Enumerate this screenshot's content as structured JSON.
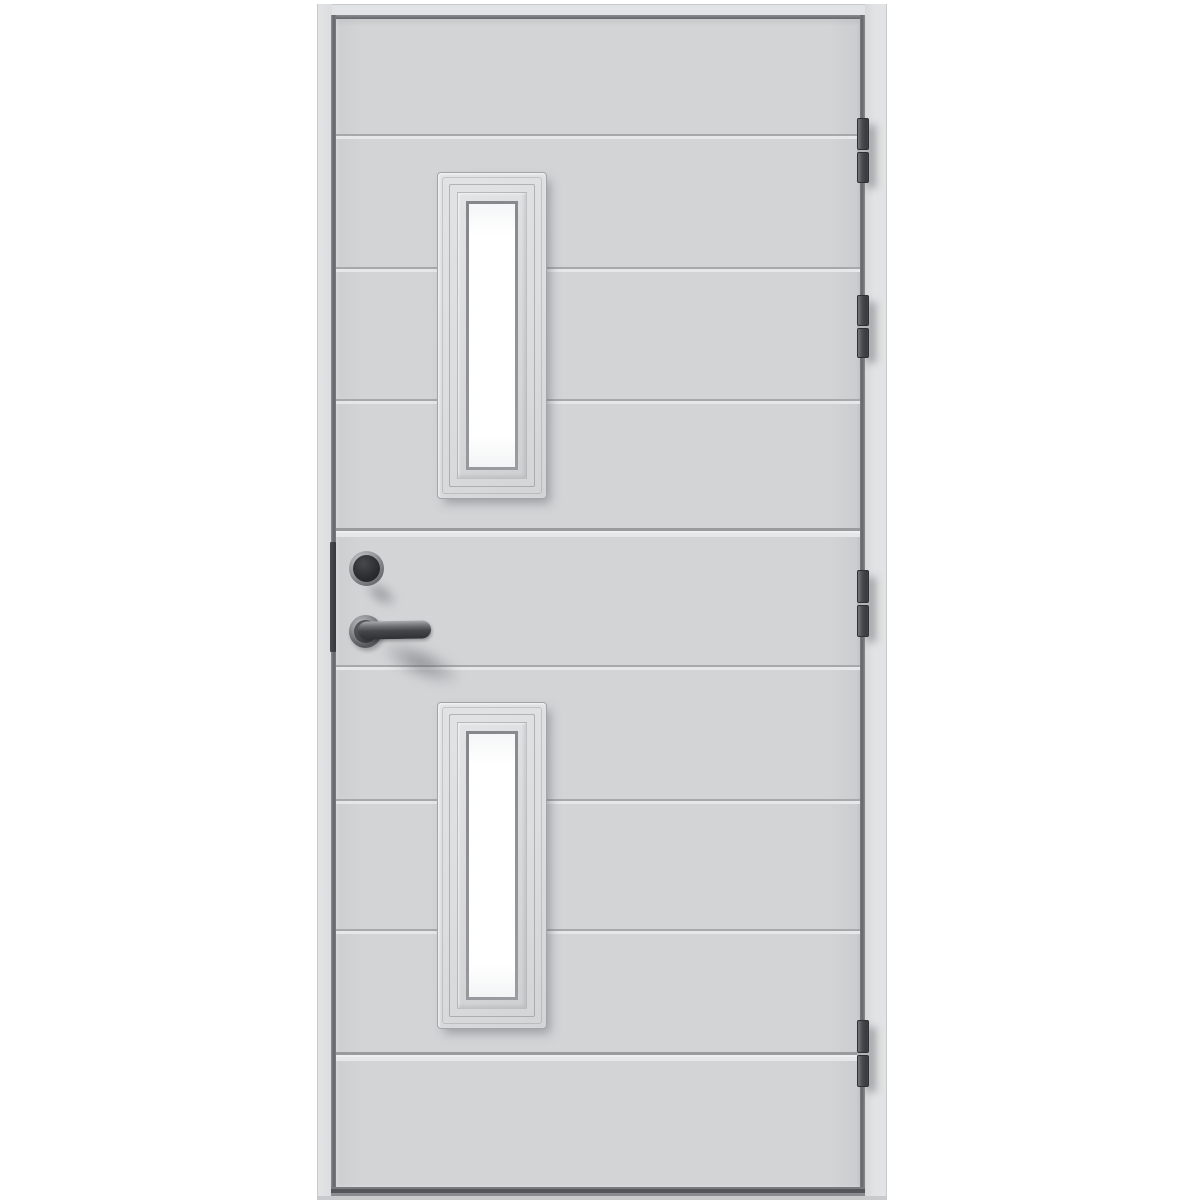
{
  "scene": {
    "type": "product-photo",
    "description": "Studio photograph of a light grey exterior entry door on a white background. The door leaf has horizontal plank grooves, two narrow vertical frosted-glass windows (one upper, one lower), a dark lever handle with round rosette, a round lock cylinder above the handle, an edge lock faceplate on the left edge, and four barrel hinges on the right edge.",
    "background_color": "#ffffff"
  },
  "door": {
    "leaf_finish": "light grey painted, horizontal plank pattern",
    "plank_groove_count": 6,
    "panel_seam_count": 2,
    "windows": {
      "count": 2,
      "shape": "narrow vertical rectangle with stepped moulding trim",
      "glass": "white frosted"
    },
    "hardware": {
      "handle": "dark metal lever handle on round rosette",
      "lock_cylinder": "round dark cylinder above handle",
      "edge_faceplate": "dark lock faceplate on left door edge",
      "hinge_count": 4,
      "hinge_side": "right"
    }
  },
  "colors": {
    "page_background": "#ffffff",
    "casing": "#e2e3e4",
    "casing_edge": "#c8c9cb",
    "gap_dark": "#65666a",
    "door_face": "#d3d4d6",
    "groove_dark": "#a7a8aa",
    "groove_light": "#e6e7e8",
    "window_trim": "#dcdddf",
    "trim_outline": "#a3a4a7",
    "bezel": "#9b9c9f",
    "glass_white": "#ffffff",
    "hinge_body": "#4b4c50",
    "hinge_edge": "#2f3034",
    "hardware_core": "#2b2c2f",
    "hardware_metal": "#c6c7c9",
    "faceplate": "#36373b",
    "bottom_band": "#55565a",
    "threshold": "#c9cacc"
  }
}
